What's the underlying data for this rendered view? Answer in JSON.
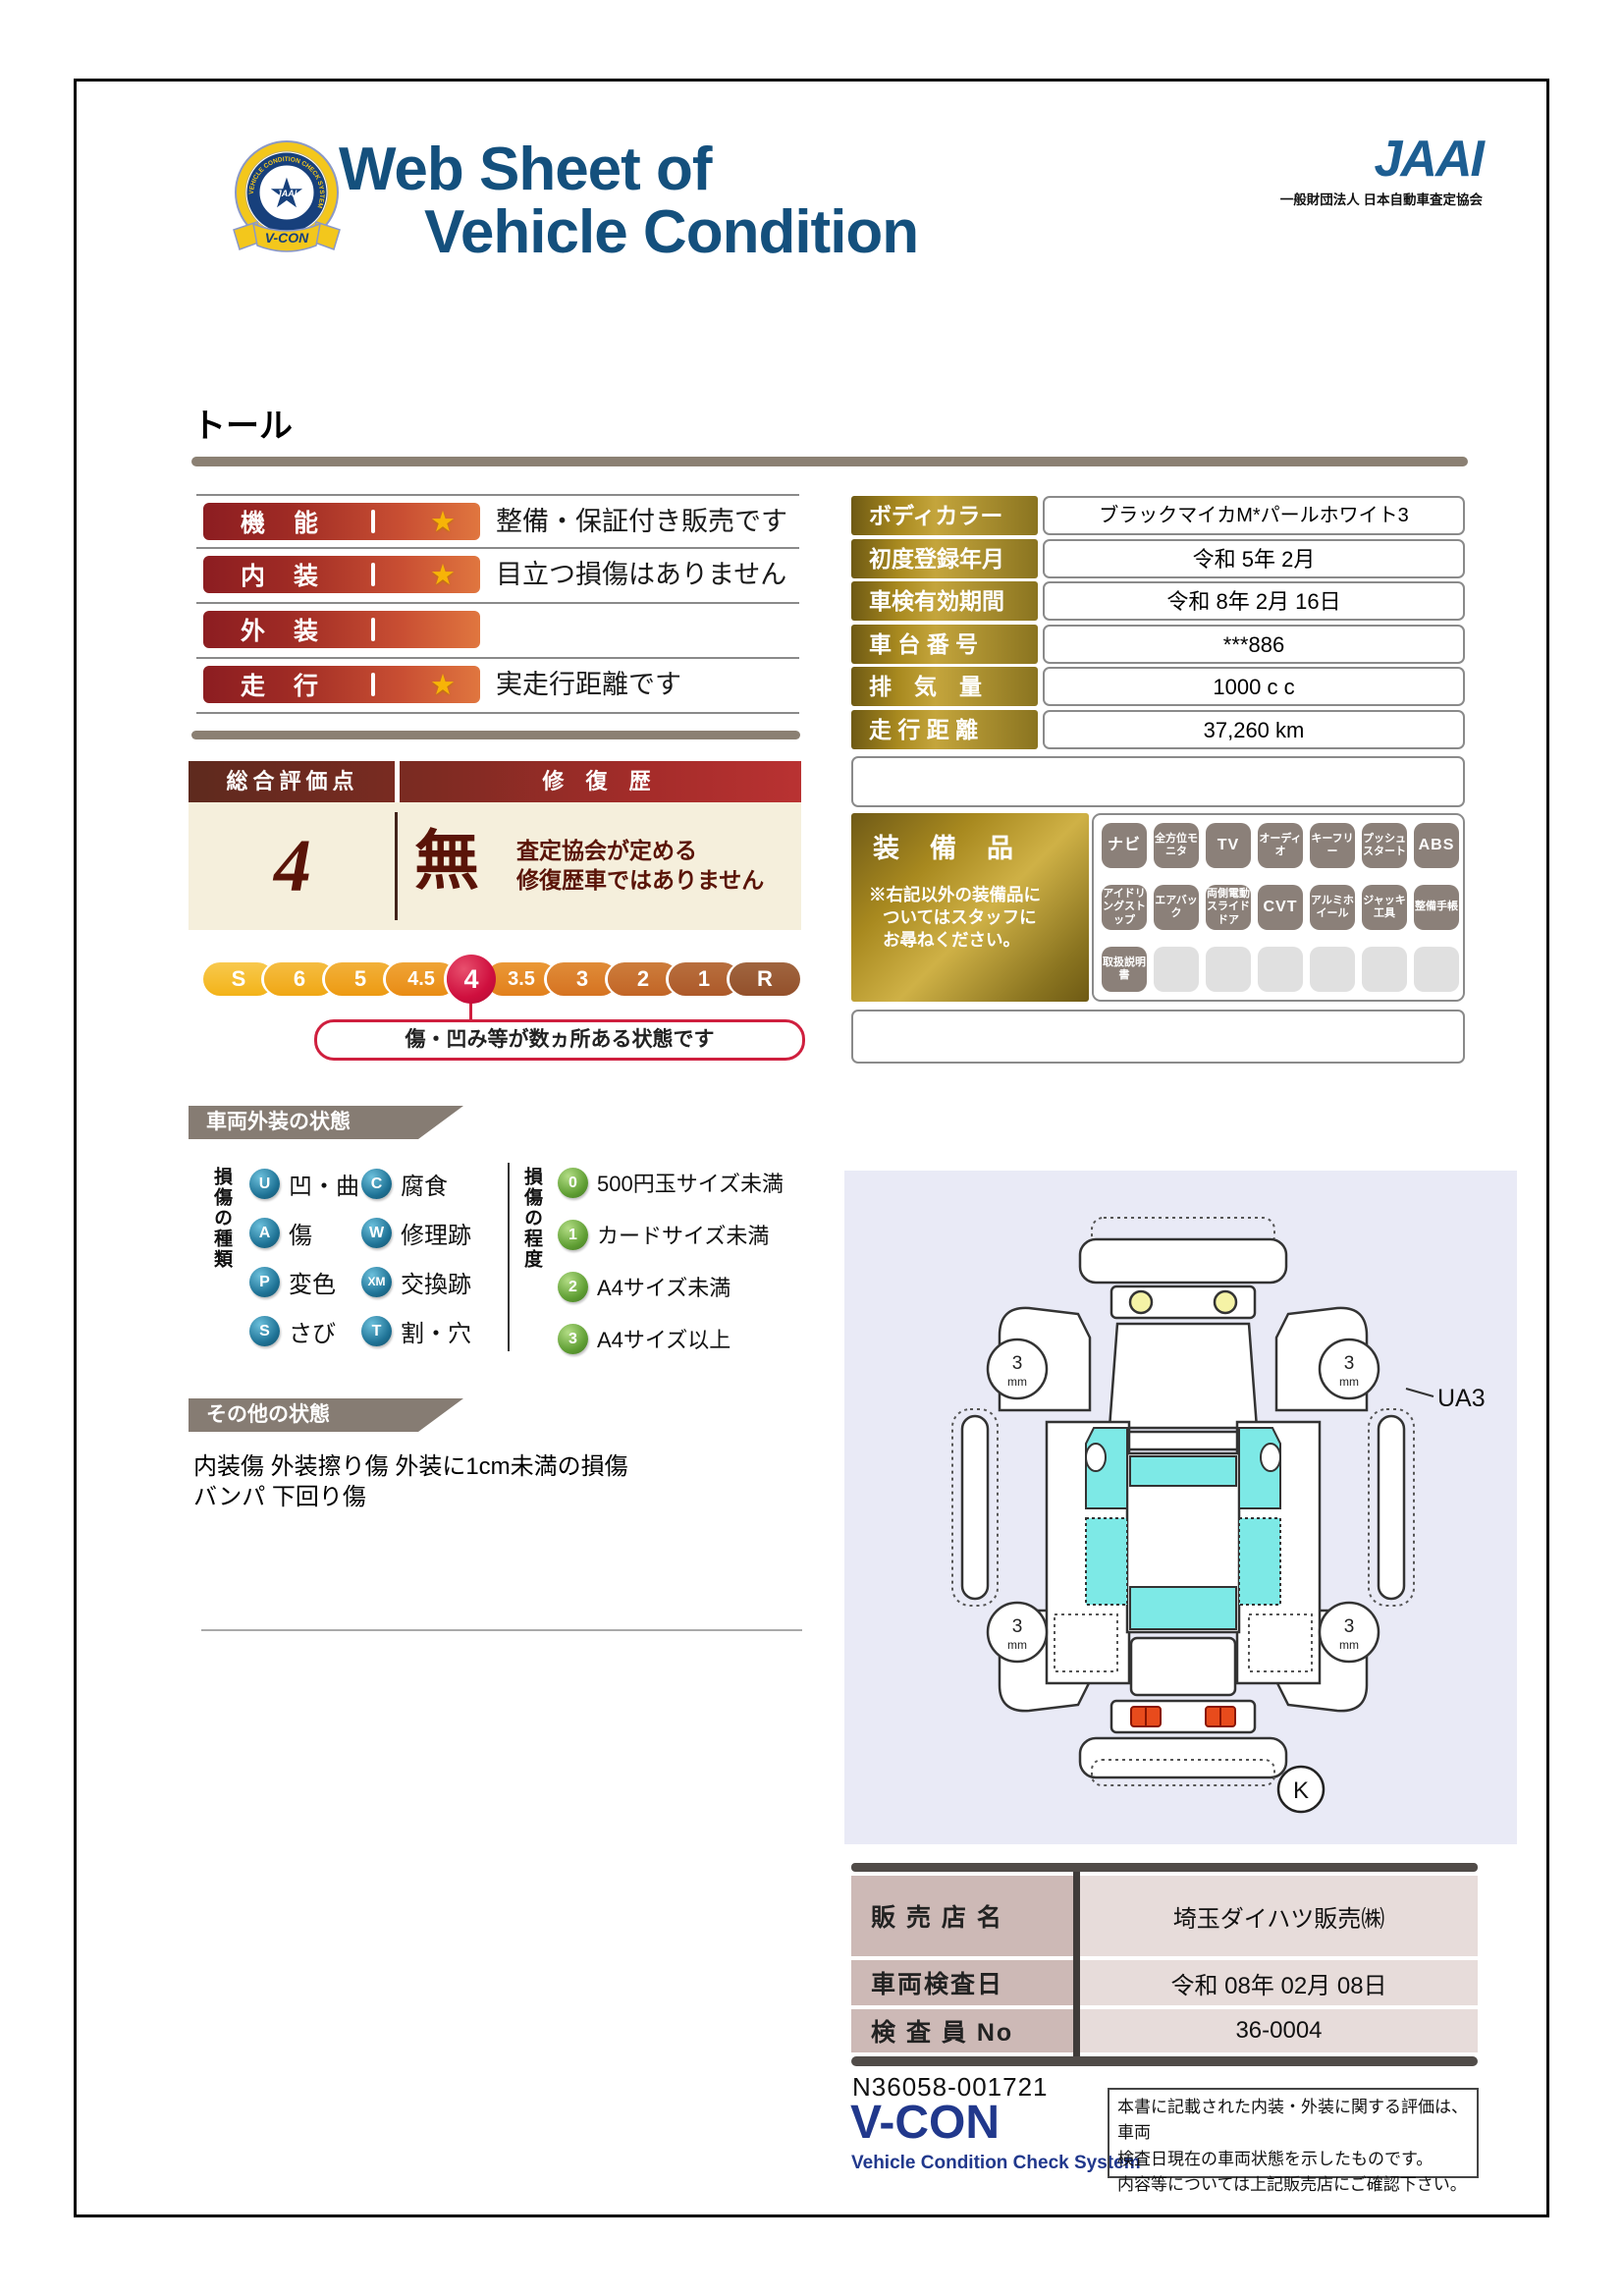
{
  "colors": {
    "title_blue": "#14507d",
    "bar_red": "#8c1d21",
    "bar_orange": "#e0763f",
    "gold": "#c4a53c",
    "crimson": "#cf0f3e",
    "maroon": "#5a1408",
    "section_gray": "#867c73",
    "tile_gray": "#8b8079",
    "diagram_bg": "#e9eaf6",
    "glass_cyan": "#7de9e6",
    "footer_blue": "#21388c"
  },
  "header": {
    "badge_text": "V-CON",
    "badge_ring": "VEHICLE CONDITION CHECK SYSTEM",
    "badge_star_text": "JAAI",
    "title_line1": "Web Sheet of",
    "title_line2": "Vehicle Condition",
    "jaai_logo": "JAAI",
    "jaai_subtitle": "一般財団法人 日本自動車査定協会"
  },
  "vehicle_name": "トール",
  "ratings": {
    "rows": [
      {
        "label": "機　能",
        "star": "★",
        "description": "整備・保証付き販売です"
      },
      {
        "label": "内　装",
        "star": "★",
        "description": "目立つ損傷はありません"
      },
      {
        "label": "外　装",
        "star": "",
        "description": ""
      },
      {
        "label": "走　行",
        "star": "★",
        "description": "実走行距離です"
      }
    ]
  },
  "overall": {
    "score_label": "総合評価点",
    "repair_label": "修 復 歴",
    "score": "4",
    "repair_value": "無",
    "repair_note1": "査定協会が定める",
    "repair_note2": "修復歴車ではありません"
  },
  "scale": {
    "items": [
      "S",
      "6",
      "5",
      "4.5",
      "4",
      "3.5",
      "3",
      "2",
      "1",
      "R"
    ],
    "selected": "4",
    "bubble": "傷・凹み等が数ヵ所ある状態です"
  },
  "vehicle_info": {
    "rows": [
      {
        "label": "ボディカラー",
        "value": "ブラックマイカM*パールホワイト3"
      },
      {
        "label": "初度登録年月",
        "value": "令和 5年 2月"
      },
      {
        "label": "車検有効期間",
        "value": "令和 8年 2月 16日"
      },
      {
        "label": "車 台 番 号",
        "value": "***886"
      },
      {
        "label": "排　気　量",
        "value": "1000 c c"
      },
      {
        "label": "走 行 距 離",
        "value": "37,260 km"
      }
    ]
  },
  "equipment": {
    "title": "装　備　品",
    "note1": "※右記以外の装備品に",
    "note2": "ついてはスタッフに",
    "note3": "お尋ねください。",
    "items": [
      "ナビ",
      "全方位モニタ",
      "TV",
      "オーディオ",
      "キーフリー",
      "プッシュスタート",
      "ABS",
      "アイドリングストップ",
      "エアバック",
      "両側電動スライドドア",
      "CVT",
      "アルミホイール",
      "ジャッキ工具",
      "整備手帳",
      "取扱説明書"
    ]
  },
  "exterior": {
    "title": "車両外装の状態",
    "type_axis": "損傷の種類",
    "types": [
      {
        "code": "U",
        "label": "凹・曲"
      },
      {
        "code": "A",
        "label": "傷"
      },
      {
        "code": "P",
        "label": "変色"
      },
      {
        "code": "S",
        "label": "さび"
      },
      {
        "code": "C",
        "label": "腐食"
      },
      {
        "code": "W",
        "label": "修理跡"
      },
      {
        "code": "XM",
        "label": "交換跡"
      },
      {
        "code": "T",
        "label": "割・穴"
      }
    ],
    "degree_axis": "損傷の程度",
    "degrees": [
      {
        "code": "0",
        "label": "500円玉サイズ未満"
      },
      {
        "code": "1",
        "label": "カードサイズ未満"
      },
      {
        "code": "2",
        "label": "A4サイズ未満"
      },
      {
        "code": "3",
        "label": "A4サイズ以上"
      }
    ]
  },
  "other": {
    "title": "その他の状態",
    "line1": "内装傷 外装擦り傷 外装に1cm未満の損傷",
    "line2": "バンパ 下回り傷"
  },
  "diagram": {
    "tire_value": "3",
    "tire_unit": "mm",
    "panel_code": "UA3",
    "mark": "K"
  },
  "dealer": {
    "rows": [
      {
        "label": "販 売 店 名",
        "value": "埼玉ダイハツ販売㈱"
      },
      {
        "label": "車両検査日",
        "value": "令和 08年 02月 08日"
      },
      {
        "label": "検 査 員 No",
        "value": "36-0004"
      }
    ]
  },
  "footer": {
    "serial": "N36058-001721",
    "logo": "V-CON",
    "logo_sub": "Vehicle Condition Check System",
    "disclaimer1": "本書に記載された内装・外装に関する評価は、車両",
    "disclaimer2": "検査日現在の車両状態を示したものです。",
    "disclaimer3": "内容等については上記販売店にご確認下さい。"
  }
}
